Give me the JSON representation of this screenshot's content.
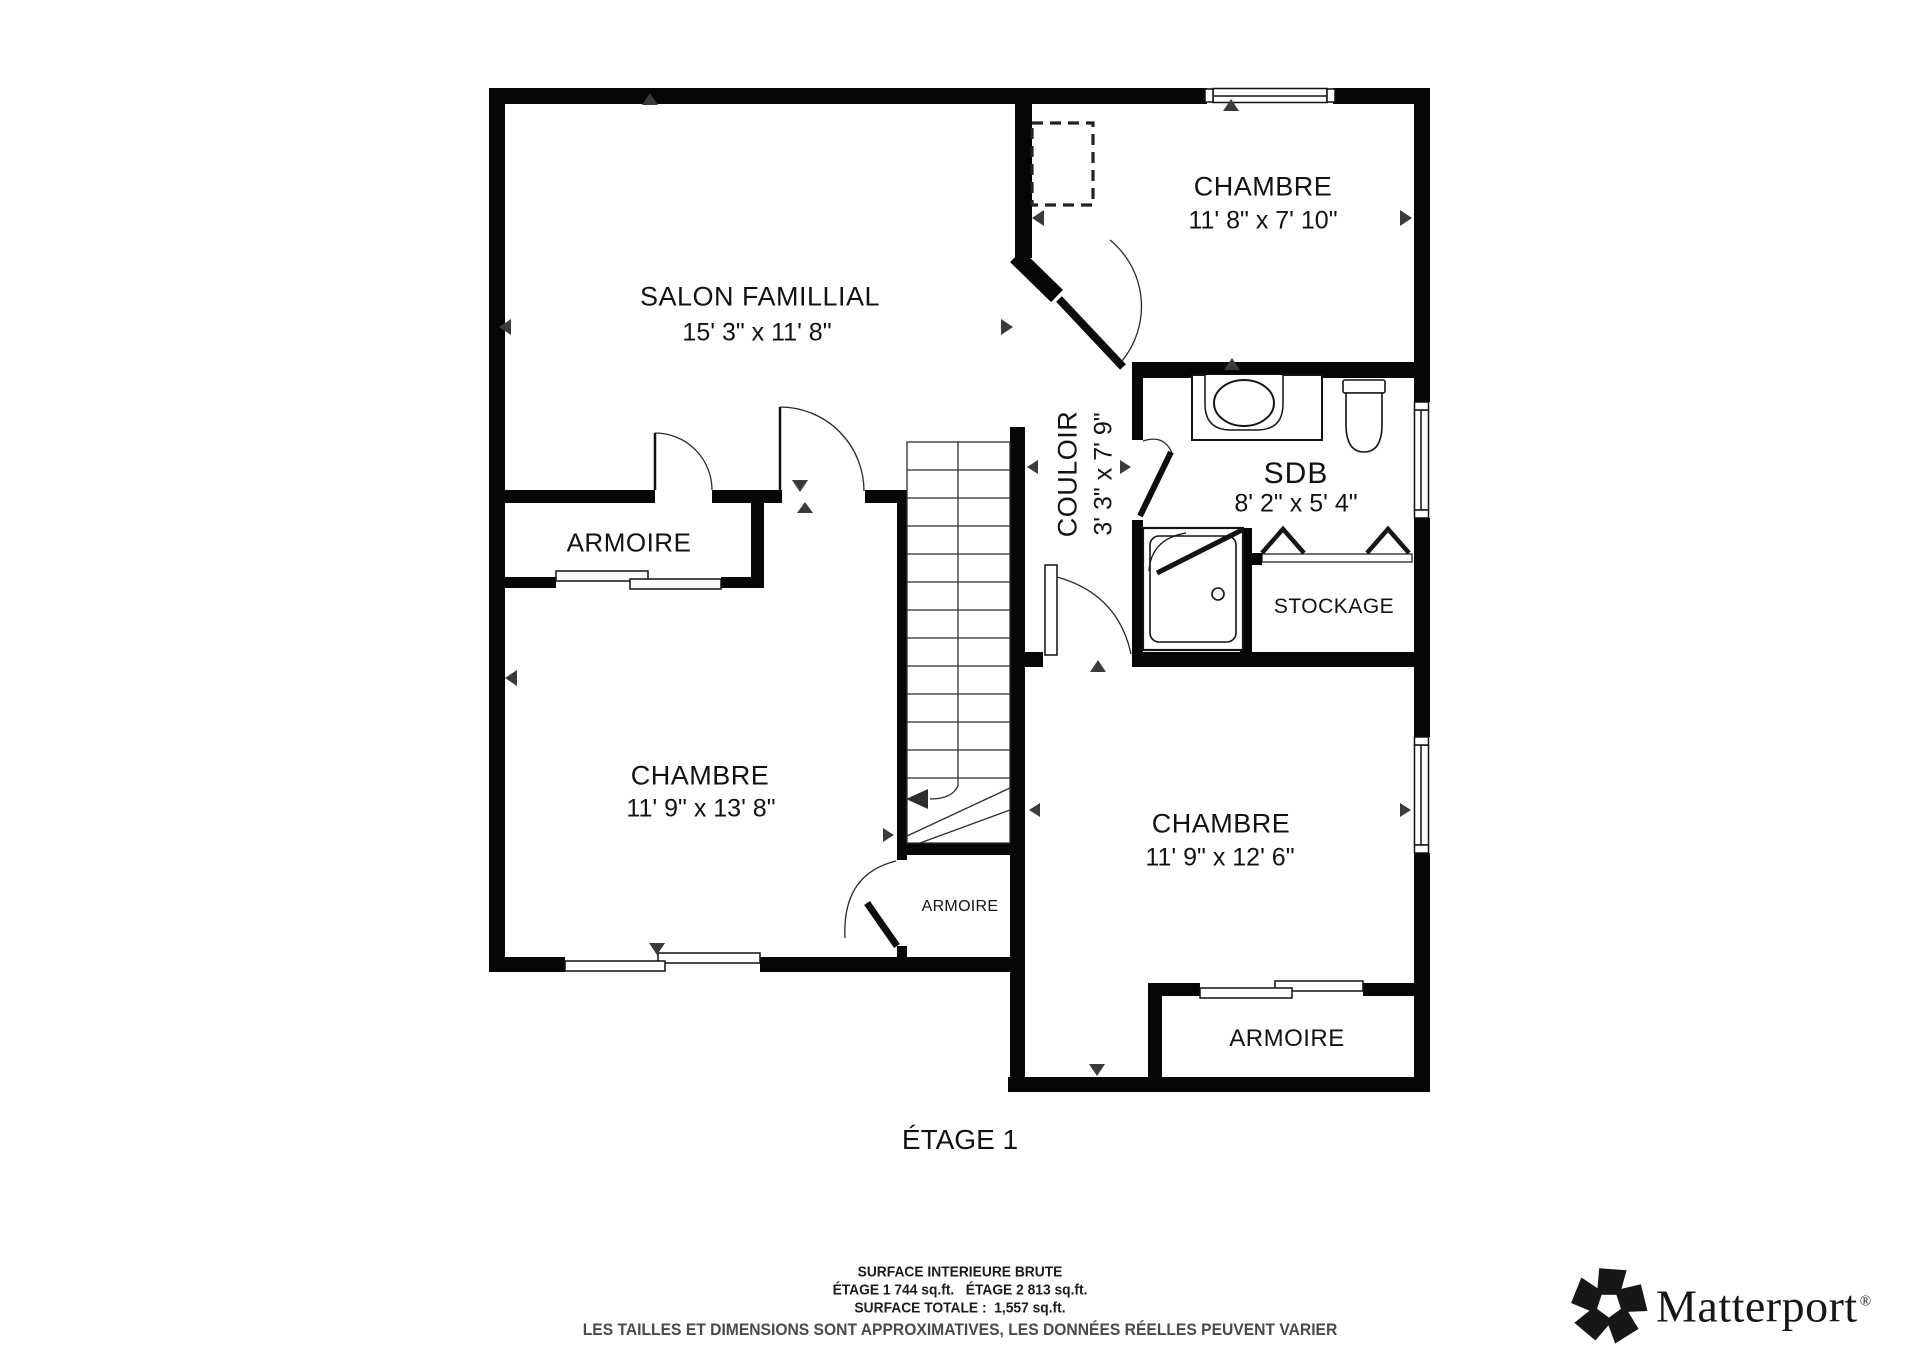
{
  "plan": {
    "title": "ÉTAGE 1",
    "rooms": {
      "salon": {
        "name": "SALON FAMILLIAL",
        "dims": "15' 3\" x 11' 8\""
      },
      "chambre_top": {
        "name": "CHAMBRE",
        "dims": "11' 8\" x 7' 10\""
      },
      "chambre_left": {
        "name": "CHAMBRE",
        "dims": "11' 9\" x 13' 8\""
      },
      "chambre_bottom": {
        "name": "CHAMBRE",
        "dims": "11' 9\" x 12' 6\""
      },
      "couloir": {
        "name": "COULOIR",
        "dims": "3' 3\" x 7' 9\""
      },
      "sdb": {
        "name": "SDB",
        "dims": "8' 2\" x 5' 4\""
      },
      "stockage": {
        "name": "STOCKAGE"
      },
      "armoire_left": {
        "name": "ARMOIRE"
      },
      "armoire_center": {
        "name": "ARMOIRE"
      },
      "armoire_bottom": {
        "name": "ARMOIRE"
      }
    },
    "wall_color": "#060606"
  },
  "footer": {
    "line1": "SURFACE INTERIEURE BRUTE",
    "line2": "ÉTAGE 1 744 sq.ft.   ÉTAGE 2 813 sq.ft.",
    "line3": "SURFACE TOTALE :  1,557 sq.ft.",
    "disclaimer": "LES TAILLES ET DIMENSIONS SONT APPROXIMATIVES, LES DONNÉES RÉELLES PEUVENT VARIER"
  },
  "logo": {
    "brand": "Matterport",
    "registered": "®"
  }
}
